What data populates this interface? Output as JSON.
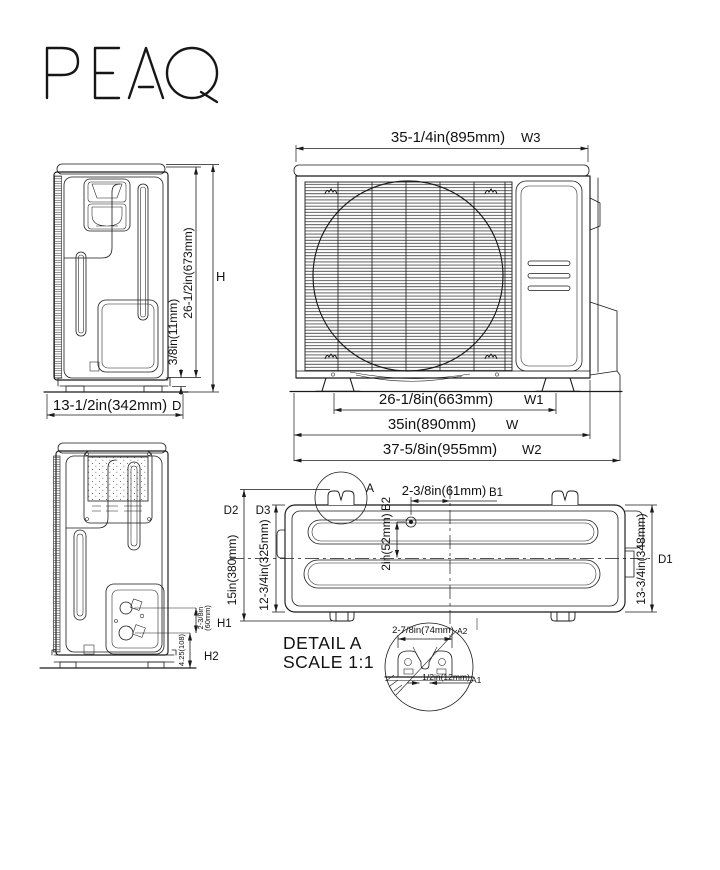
{
  "brand": {
    "logo": "PEAQ"
  },
  "front_view": {
    "top_width": {
      "value": "35-1/4in(895mm)",
      "label": "W3"
    },
    "feet_span": {
      "value": "26-1/8in(663mm)",
      "label": "W1"
    },
    "body_width": {
      "value": "35in(890mm)",
      "label": "W"
    },
    "overall_width": {
      "value": "37-5/8in(955mm)",
      "label": "W2"
    }
  },
  "side_view": {
    "depth": {
      "value": "13-1/2in(342mm)",
      "label": "D"
    },
    "body_height": {
      "value": "26-1/2in(673mm)"
    },
    "base_height": {
      "value": "3/8in(11mm)"
    },
    "total_height": {
      "label": "H"
    }
  },
  "back_view": {
    "valve_spacing": {
      "value": "2-3/8in",
      "value2": "(60mm)",
      "label": "H1"
    },
    "valve_height": {
      "value": "4.25(108)",
      "label": "H2"
    }
  },
  "top_view": {
    "detail_marker": "A",
    "screw_to_center": {
      "value": "2-3/8in(61mm)",
      "label": "B1"
    },
    "screw_inset": {
      "value": "2in(52mm)",
      "label": "B2"
    },
    "overall_depth": {
      "value": "15in(380mm)",
      "label": "D2"
    },
    "inner_depth": {
      "value": "12-3/4in(325mm)",
      "label": "D3"
    },
    "right_depth": {
      "value": "13-3/4in(348mm)",
      "label": "D1"
    }
  },
  "detail_a": {
    "title": "DETAIL A",
    "scale": "SCALE 1:1",
    "bracket_width": {
      "value": "2-7/8in(74mm)",
      "label": "A2"
    },
    "slot_width": {
      "value": "1/2in(12mm)",
      "label": "A1"
    }
  },
  "colors": {
    "line": "#1a1a1a",
    "background": "#ffffff"
  }
}
